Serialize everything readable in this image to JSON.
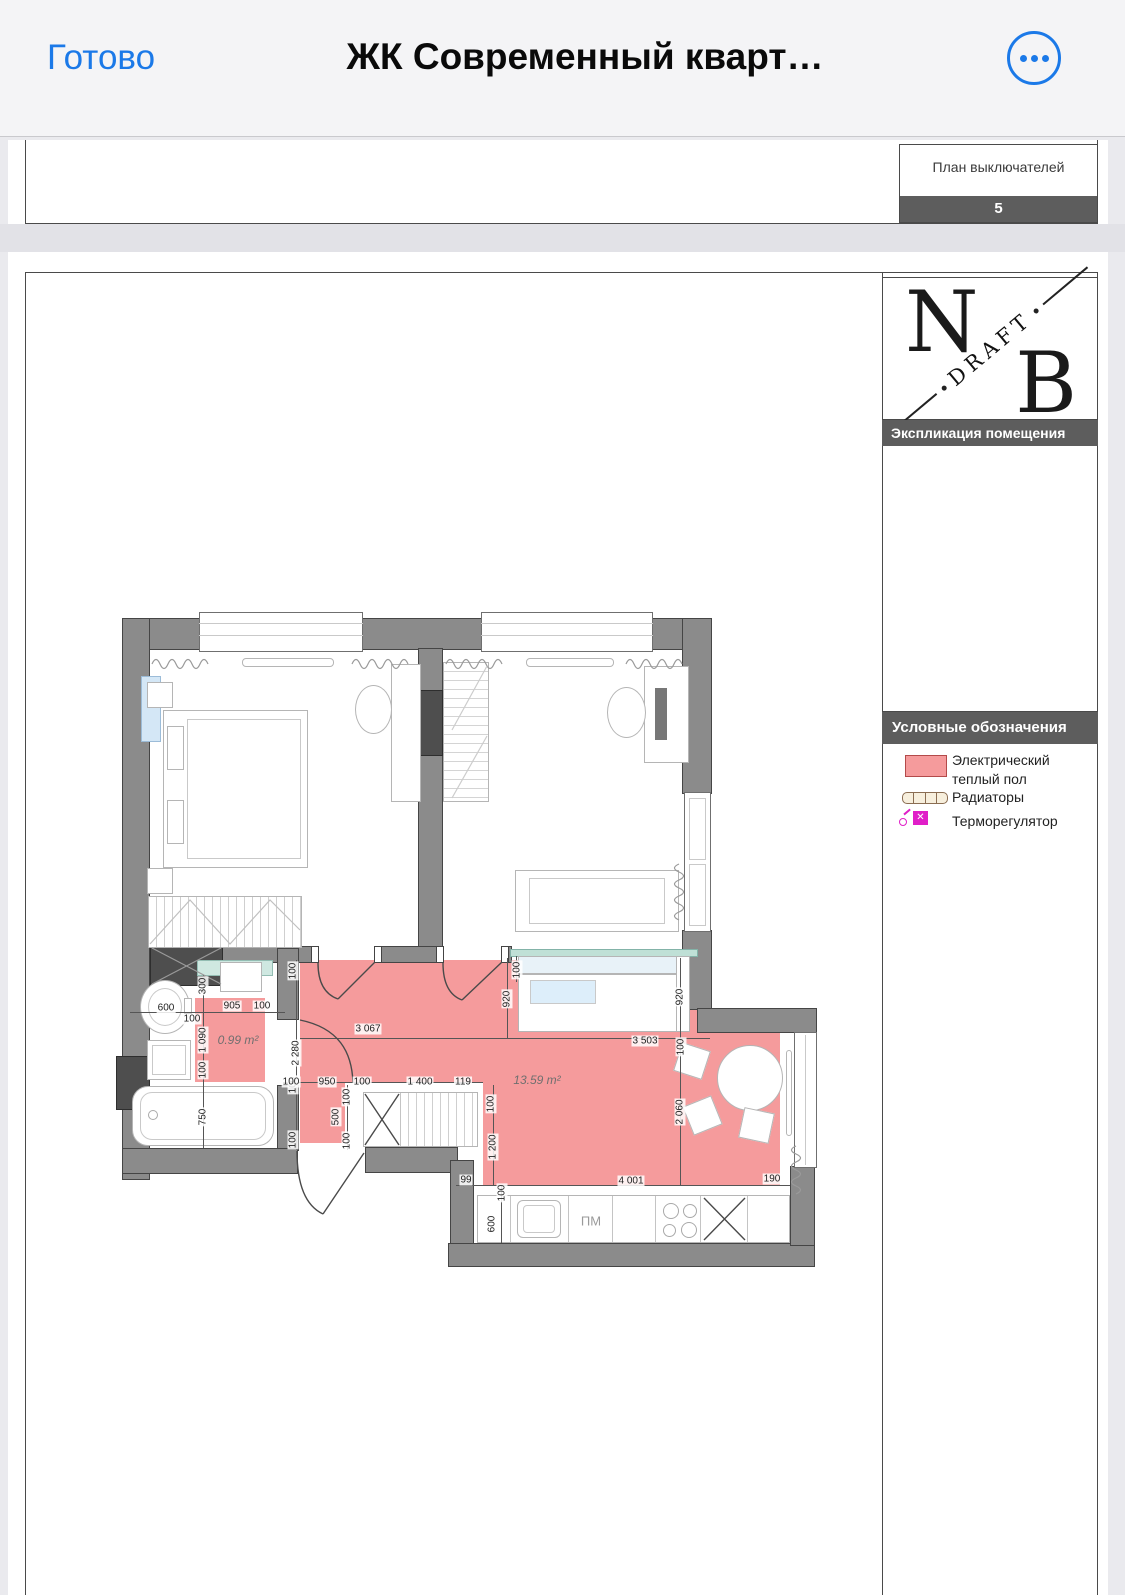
{
  "navbar": {
    "done": "Готово",
    "title": "ЖК Современный кварт…"
  },
  "prev_page_stamp": {
    "title": "План выключателей",
    "page_number": "5"
  },
  "logo": {
    "n": "N",
    "b": "B",
    "draft": "DRAFT"
  },
  "column": {
    "explication_title": "Экспликация помещения",
    "legend_title": "Условные обозначения",
    "legend": {
      "items": [
        {
          "icon": "heated-floor-swatch",
          "label": "Электрический\nтеплый пол"
        },
        {
          "icon": "radiator-icon",
          "label": "Радиаторы"
        },
        {
          "icon": "thermoregulator-icon",
          "label": "Терморегулятор"
        }
      ]
    }
  },
  "plan": {
    "areas": [
      {
        "text": "0.99 m²"
      },
      {
        "text": "13.59 m²"
      }
    ],
    "appliances": [
      {
        "text": "ПМ"
      }
    ],
    "dimensions": [
      {
        "t": "3 067",
        "x": 368,
        "y": 1029,
        "v": 0
      },
      {
        "t": "3 503",
        "x": 645,
        "y": 1041,
        "v": 0
      },
      {
        "t": "2 280",
        "x": 296,
        "y": 1053,
        "v": 1
      },
      {
        "t": "920",
        "x": 507,
        "y": 999,
        "v": 1
      },
      {
        "t": "100",
        "x": 517,
        "y": 970,
        "v": 1
      },
      {
        "t": "920",
        "x": 680,
        "y": 997,
        "v": 1
      },
      {
        "t": "100",
        "x": 681,
        "y": 1047,
        "v": 1
      },
      {
        "t": "2 060",
        "x": 680,
        "y": 1112,
        "v": 1
      },
      {
        "t": "4 001",
        "x": 631,
        "y": 1181,
        "v": 0
      },
      {
        "t": "190",
        "x": 772,
        "y": 1179,
        "v": 0
      },
      {
        "t": "99",
        "x": 466,
        "y": 1180,
        "v": 0
      },
      {
        "t": "100",
        "x": 502,
        "y": 1193,
        "v": 1
      },
      {
        "t": "600",
        "x": 492,
        "y": 1224,
        "v": 1
      },
      {
        "t": "100",
        "x": 293,
        "y": 971,
        "v": 1
      },
      {
        "t": "100",
        "x": 293,
        "y": 1085,
        "v": 1
      },
      {
        "t": "100",
        "x": 293,
        "y": 1140,
        "v": 1
      },
      {
        "t": "300",
        "x": 203,
        "y": 986,
        "v": 1
      },
      {
        "t": "1 090",
        "x": 203,
        "y": 1040,
        "v": 1
      },
      {
        "t": "100",
        "x": 203,
        "y": 1070,
        "v": 1
      },
      {
        "t": "750",
        "x": 203,
        "y": 1117,
        "v": 1
      },
      {
        "t": "600",
        "x": 166,
        "y": 1008,
        "v": 0
      },
      {
        "t": "100",
        "x": 192,
        "y": 1019,
        "v": 0
      },
      {
        "t": "905",
        "x": 232,
        "y": 1006,
        "v": 0
      },
      {
        "t": "100",
        "x": 262,
        "y": 1006,
        "v": 0
      },
      {
        "t": "100",
        "x": 291,
        "y": 1082,
        "v": 0
      },
      {
        "t": "950",
        "x": 327,
        "y": 1082,
        "v": 0
      },
      {
        "t": "100",
        "x": 362,
        "y": 1082,
        "v": 0
      },
      {
        "t": "1 400",
        "x": 420,
        "y": 1082,
        "v": 0
      },
      {
        "t": "119",
        "x": 463,
        "y": 1082,
        "v": 0
      },
      {
        "t": "500",
        "x": 336,
        "y": 1117,
        "v": 1
      },
      {
        "t": "100",
        "x": 347,
        "y": 1097,
        "v": 1
      },
      {
        "t": "100",
        "x": 347,
        "y": 1141,
        "v": 1
      },
      {
        "t": "100",
        "x": 491,
        "y": 1104,
        "v": 1
      },
      {
        "t": "1 200",
        "x": 493,
        "y": 1147,
        "v": 1
      }
    ]
  },
  "colors": {
    "accent_blue": "#1b79e8",
    "heated_floor": "#f59b9c",
    "heated_floor_border": "#b34a4a",
    "header_bar": "#5d5d5d",
    "wall_gray": "#8b8b8b",
    "thermoregulator_magenta": "#e01ec8",
    "glass_teal": "#bfe0d6"
  }
}
